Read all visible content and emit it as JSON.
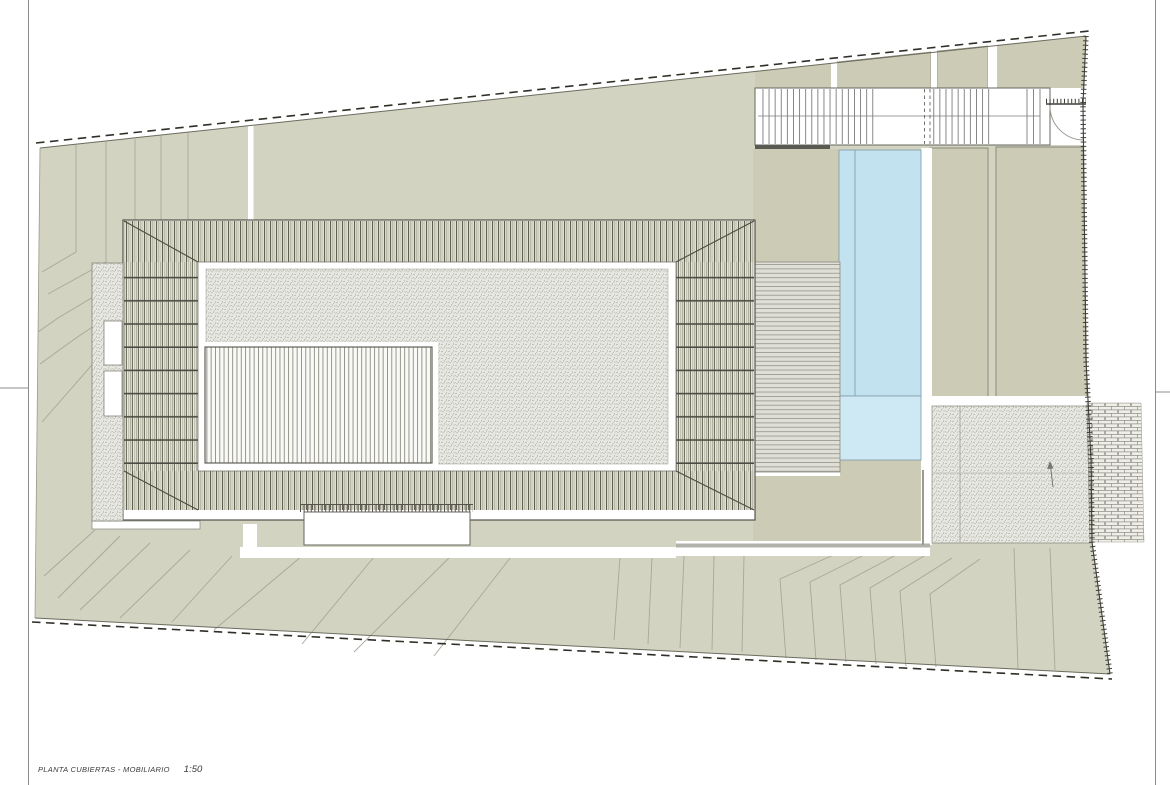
{
  "sheet": {
    "title_label": "PLANTA CUBIERTAS - MOBILIARIO",
    "scale_label": "1:50"
  },
  "drawing": {
    "type": "architectural-roof-site-plan",
    "colors": {
      "terrain": "#d3d3c2",
      "bed": "#cbcbb6",
      "pool_upper": "#c3e2ef",
      "pool_lower": "#cfe9f4",
      "line": "#55524a",
      "contour": "#a8a89a",
      "gray_strip": "#b2b2aa",
      "paper": "#ffffff"
    },
    "visible_features": [
      "dashed site boundary",
      "terrain contour lines",
      "slatted pergola roof with hip diagonals",
      "gravel roof courtyard",
      "ribbed skylight panel",
      "lap pool with lane line",
      "entry stair walkway with door swing",
      "stippled gravel terrace",
      "cobblestone paving",
      "bench with louvre shade",
      "west gravel strip with two skylights"
    ]
  }
}
